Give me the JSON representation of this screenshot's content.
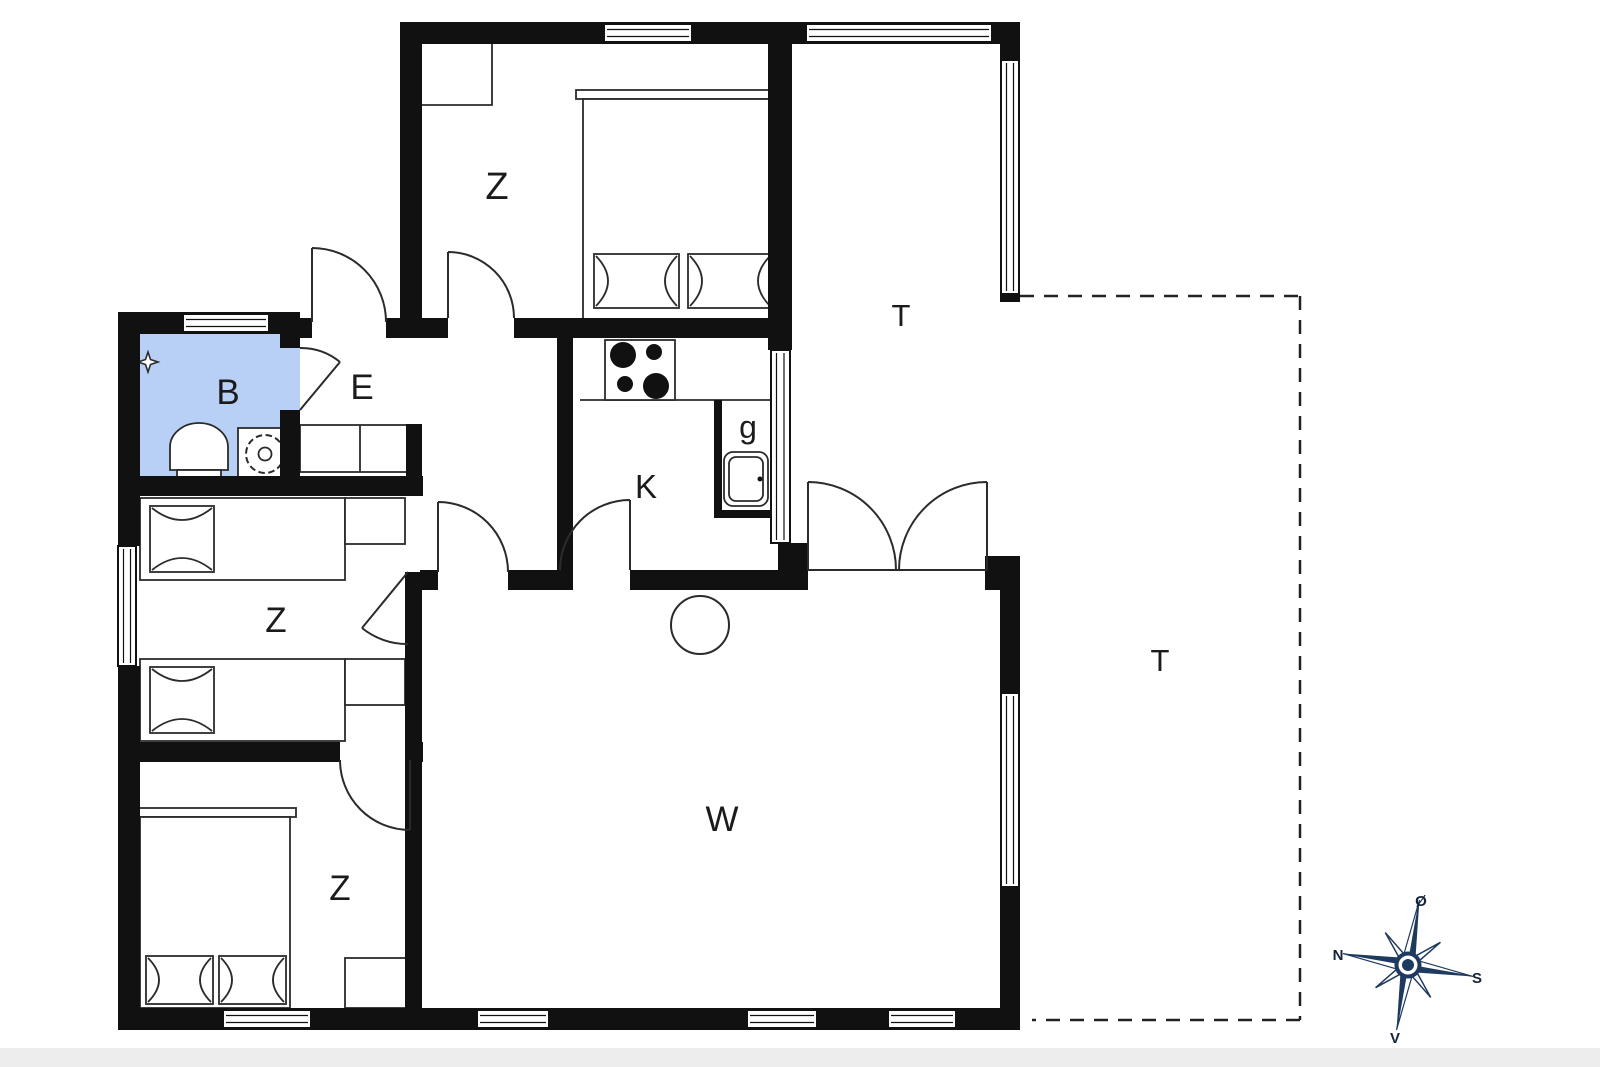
{
  "title": "Floor plan",
  "rooms": [
    {
      "id": "bedroom-top",
      "label": "Z"
    },
    {
      "id": "terrace-covered",
      "label": "T"
    },
    {
      "id": "bathroom",
      "label": "B"
    },
    {
      "id": "entrance",
      "label": "E"
    },
    {
      "id": "kitchen",
      "label": "K"
    },
    {
      "id": "guest-wc",
      "label": "g"
    },
    {
      "id": "bedroom-twin",
      "label": "Z"
    },
    {
      "id": "bedroom-double",
      "label": "Z"
    },
    {
      "id": "living-room",
      "label": "W"
    },
    {
      "id": "terrace-open",
      "label": "T"
    }
  ],
  "compass": {
    "north": "N",
    "east": "Ø",
    "south": "S",
    "west": "V"
  },
  "colors": {
    "wall_color": "#111111",
    "line_color": "#2b2b2b",
    "bathroom_fill": "#b8d0f6",
    "compass_navy": "#1f3a5f",
    "bottom_strip": "#ededed"
  }
}
